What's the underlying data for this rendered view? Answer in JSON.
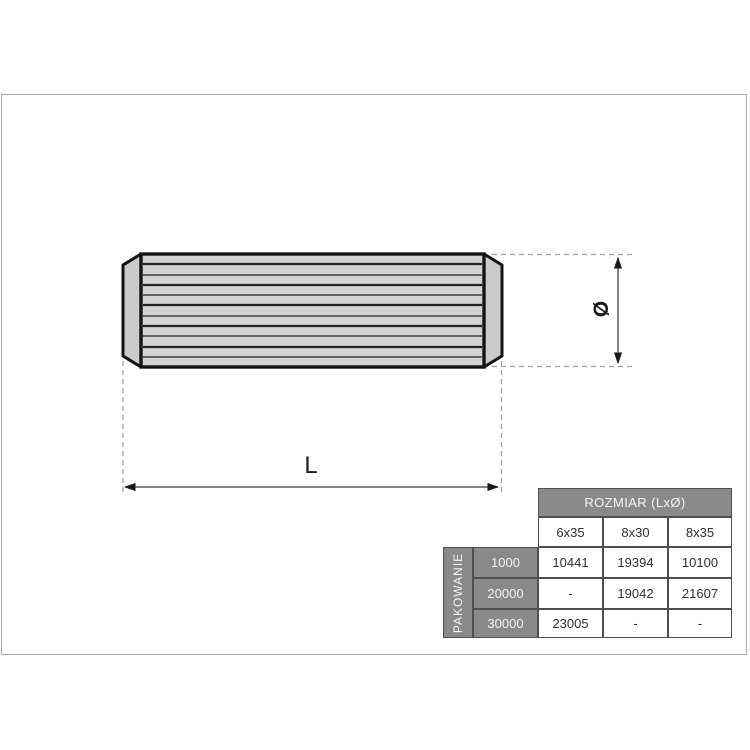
{
  "drawing": {
    "length_label": "L",
    "diameter_label": "Ø"
  },
  "table": {
    "size_header": "ROZMIAR (LxØ)",
    "packaging_label": "PAKOWANIE",
    "size_columns": [
      "6x35",
      "8x30",
      "8x35"
    ],
    "rows": [
      {
        "qty": "1000",
        "values": [
          "10441",
          "19394",
          "10100"
        ]
      },
      {
        "qty": "20000",
        "values": [
          "-",
          "19042",
          "21607"
        ]
      },
      {
        "qty": "30000",
        "values": [
          "23005",
          "-",
          "-"
        ]
      }
    ]
  },
  "colors": {
    "table_header_gray": "#8a8a8a",
    "table_border": "#4f4f4f",
    "dowel_fill": "#d3d3d3",
    "dowel_outline": "#141414",
    "dashed_line": "#9e9e9e",
    "dimension_line": "#3f3f3f"
  }
}
